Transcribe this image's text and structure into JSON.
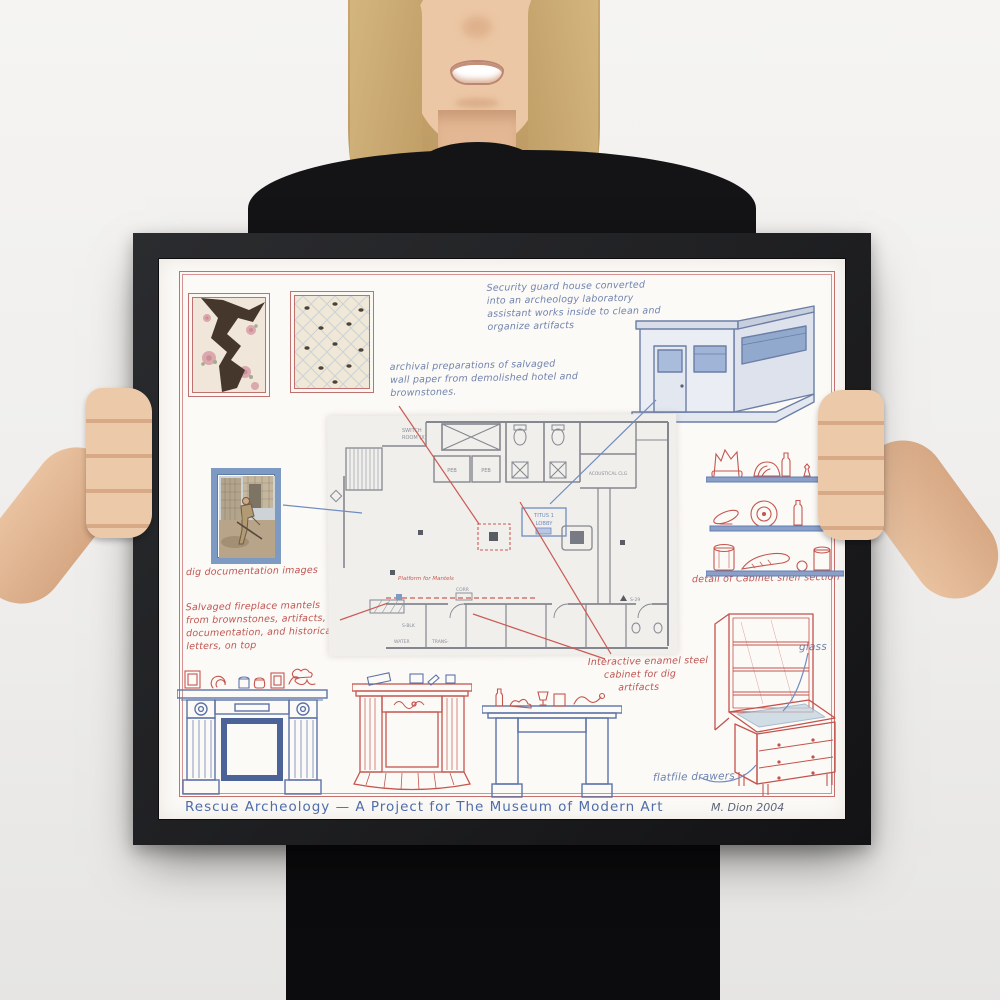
{
  "artwork": {
    "title": "Rescue Archeology — A Project for The Museum of Modern Art",
    "signature": "M. Dion 2004",
    "notes": {
      "guard_house": [
        "Security guard house converted",
        "into an archeology laboratory",
        "assistant works inside to clean and",
        "organize artifacts"
      ],
      "archival": [
        "archival preparations of salvaged",
        "wall paper from demolished hotel and",
        "brownstones."
      ],
      "dig_images": "dig documentation images",
      "salvaged_mantels": [
        "Salvaged fireplace mantels",
        "from brownstones, artifacts,",
        "documentation, and historical",
        "letters, on top"
      ],
      "platform": "Platform for Mantels",
      "shelf_detail": "detail of Cabinet shelf section",
      "cabinet": [
        "Interactive enamel steel",
        "cabinet for dig",
        "artifacts"
      ],
      "glass": "glass",
      "flatfile": "flatfile drawers"
    },
    "plan_labels": {
      "switch_room": [
        "SWITCH",
        "ROOM (X)"
      ],
      "peb_left": "PEB",
      "peb_right": "PEB",
      "acoustics": "ACOUSTICAL CLG",
      "lobby": [
        "TITUS 1",
        "LOBBY"
      ],
      "corr": "CORR",
      "s_blk": "S-BLK",
      "water": "WATER",
      "trans": "TRANS-",
      "s_29": "S-29"
    },
    "colors": {
      "red_pencil": "#c0534d",
      "blue_pencil": "#5f7db2",
      "plan_gray": "#83868f",
      "frame": "#1b1b1d"
    }
  }
}
